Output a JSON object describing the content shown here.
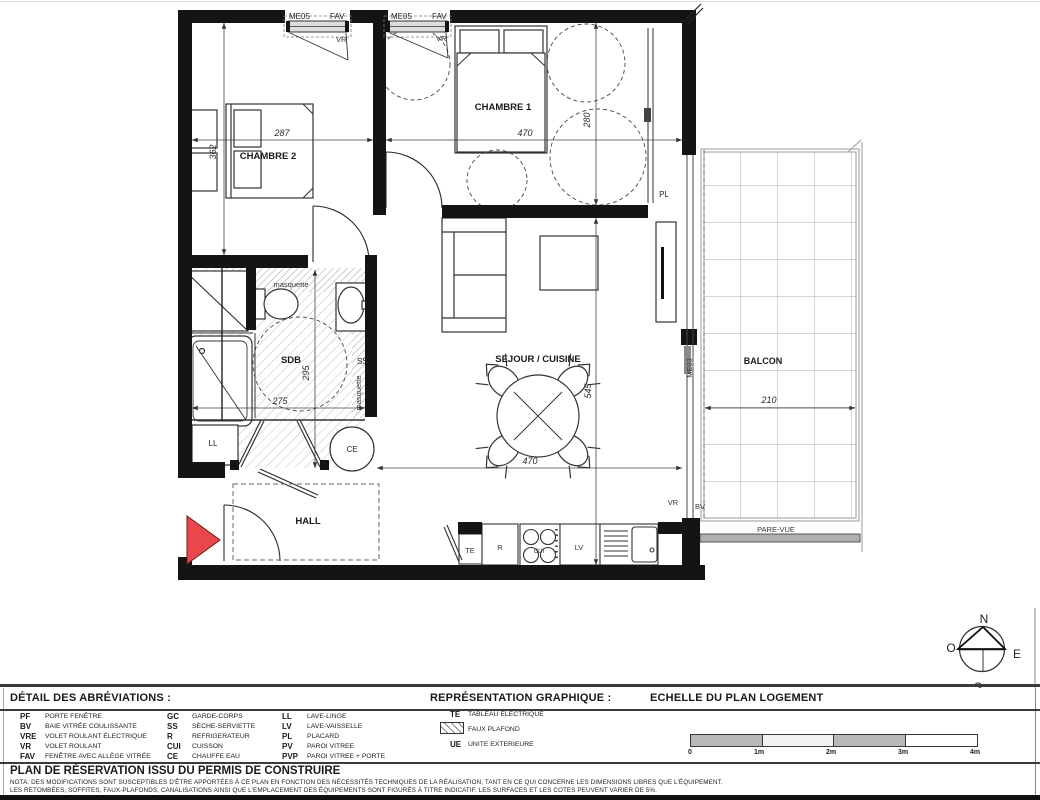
{
  "plan": {
    "windows": {
      "code": "ME05",
      "type": "FAV",
      "shutter": "VR",
      "bay_code": "ME03",
      "bay_type": "BV"
    },
    "rooms": {
      "chambre1": "CHAMBRE 1",
      "chambre2": "CHAMBRE 2",
      "sdb": "SDB",
      "sejour": "SEJOUR / CUISINE",
      "hall": "HALL",
      "balcon": "BALCON"
    },
    "labels": {
      "pl": "PL",
      "ss": "SS",
      "ll": "LL",
      "ce": "CE",
      "te": "TE",
      "refrigerator": "R",
      "cooktop": "CUI",
      "dishwasher": "LV",
      "masquette": "masquette",
      "pare_vue": "PARE-VUE"
    },
    "dims": {
      "chambre2_w": "287",
      "chambre2_h": "362",
      "chambre1_w": "470",
      "chambre1_h": "280",
      "sdb_w": "275",
      "sdb_h": "295",
      "sejour_w": "470",
      "sejour_h": "545",
      "balcon_w": "210"
    }
  },
  "compass": {
    "n": "N",
    "s": "S",
    "e": "E",
    "o": "O"
  },
  "legend": {
    "abbrev_title": "DÉTAIL DES ABRÉVIATIONS :",
    "graphic_title": "REPRÉSENTATION GRAPHIQUE :",
    "scale_title": "ECHELLE DU PLAN LOGEMENT",
    "col1": [
      {
        "abbr": "PF",
        "label": "PORTE  FENÊTRE"
      },
      {
        "abbr": "BV",
        "label": "BAIE VITRÉE COULISSANTE"
      },
      {
        "abbr": "VRE",
        "label": "VOLET ROULANT ÉLECTRIQUE"
      },
      {
        "abbr": "VR",
        "label": "VOLET ROULANT"
      },
      {
        "abbr": "FAV",
        "label": "FENÊTRE AVEC ALLÈGE VITRÉE"
      }
    ],
    "col2": [
      {
        "abbr": "GC",
        "label": "GARDE-CORPS"
      },
      {
        "abbr": "SS",
        "label": "SÈCHE-SERVIETTE"
      },
      {
        "abbr": "R",
        "label": "REFRIGERATEUR"
      },
      {
        "abbr": "CUI",
        "label": "CUISSON"
      },
      {
        "abbr": "CE",
        "label": "CHAUFFE EAU"
      }
    ],
    "col3": [
      {
        "abbr": "LL",
        "label": "LAVE-LINGE"
      },
      {
        "abbr": "LV",
        "label": "LAVE-VAISSELLE"
      },
      {
        "abbr": "PL",
        "label": "PLACARD"
      },
      {
        "abbr": "PV",
        "label": "PAROI VITREE"
      },
      {
        "abbr": "PVP",
        "label": "PAROI VITREE + PORTE"
      }
    ],
    "col4": [
      {
        "abbr": "TE",
        "label": "TABLEAU ELECTRIQUE"
      },
      {
        "abbr": "",
        "label": "FAUX PLAFOND"
      },
      {
        "abbr": "UE",
        "label": "UNITE EXTERIEURE"
      }
    ],
    "scale_ticks": [
      "0",
      "1m",
      "2m",
      "3m",
      "4m"
    ]
  },
  "footer": {
    "title": "PLAN DE RÉSERVATION ISSU DU PERMIS DE CONSTRUIRE",
    "nota_line1": "NOTA: DES MODIFICATIONS SONT SUSCEPTIBLES D'ÊTRE APPORTÉES À CE PLAN EN FONCTION DES NÉCESSITÉS TECHNIQUES DE LA RÉALISATION, TANT EN CE QUI CONCERNE LES DIMENSIONS LIBRES QUE L'ÉQUIPEMENT.",
    "nota_line2": "LES RETOMBÉES, SOFFITES, FAUX-PLAFONDS, CANALISATIONS AINSI QUE L'EMPLACEMENT DES ÉQUIPEMENTS SONT FIGURÉS À TITRE INDICATIF. LES SURFACES ET LES COTES PEUVENT VARIER DE 5%."
  },
  "colors": {
    "wall": "#141414",
    "entrance_arrow": "#e8474b",
    "hatch": "#c4c4c4",
    "balcony_line": "#adadad"
  }
}
